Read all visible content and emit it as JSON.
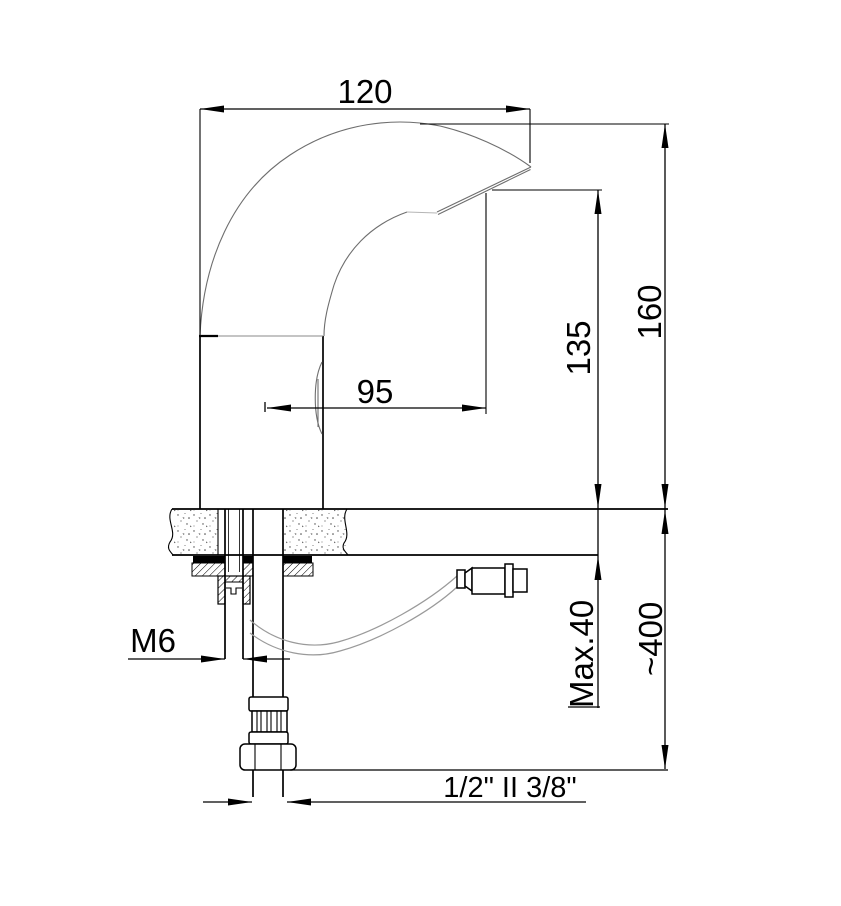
{
  "drawing": {
    "name": "sensor-faucet-installation-technical-drawing",
    "background": "#ffffff",
    "line_color": "#000000",
    "thin_line_color": "#6e6e6e",
    "labels": {
      "spout_width": "120",
      "total_height": "160",
      "spout_height": "135",
      "spout_reach": "95",
      "stud_thread": "M6",
      "max_deck_thickness": "Max.40",
      "hose_length": "~400",
      "supply_connection": "1/2\" II 3/8\""
    }
  }
}
